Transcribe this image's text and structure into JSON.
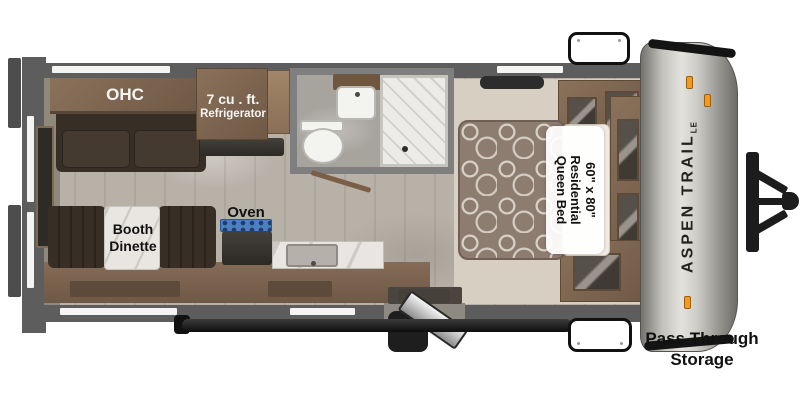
{
  "title": "Aspen Trail LE travel trailer floor plan",
  "labels": {
    "ohc": "OHC",
    "refrigerator_line1": "7 cu . ft.",
    "refrigerator_line2": "Refrigerator",
    "booth_line1": "Booth",
    "booth_line2": "Dinette",
    "oven": "Oven",
    "bed_line1": "60\" x 80\"",
    "bed_line2": "Residential",
    "bed_line3": "Queen Bed",
    "brand": "ASPEN TRAIL",
    "brand_suffix": "LE",
    "storage_line1": "Pass Through",
    "storage_line2": "Storage"
  },
  "colors": {
    "background": "#ffffff",
    "wall_gray": "#5d5d5d",
    "floor_tan": "#b7b1a8",
    "bedroom_carpet": "#d6cfc2",
    "wood_cabinet": "#7b6450",
    "dark_upholstery": "#372e26",
    "stove_blue": "#4d7fc4",
    "mattress_taupe": "#8d7d71",
    "front_cap_silver": "#c9c7c1",
    "marker_light_orange": "#f39b1f",
    "hitch_black": "#1c1c1c",
    "label_text": "#111111"
  }
}
